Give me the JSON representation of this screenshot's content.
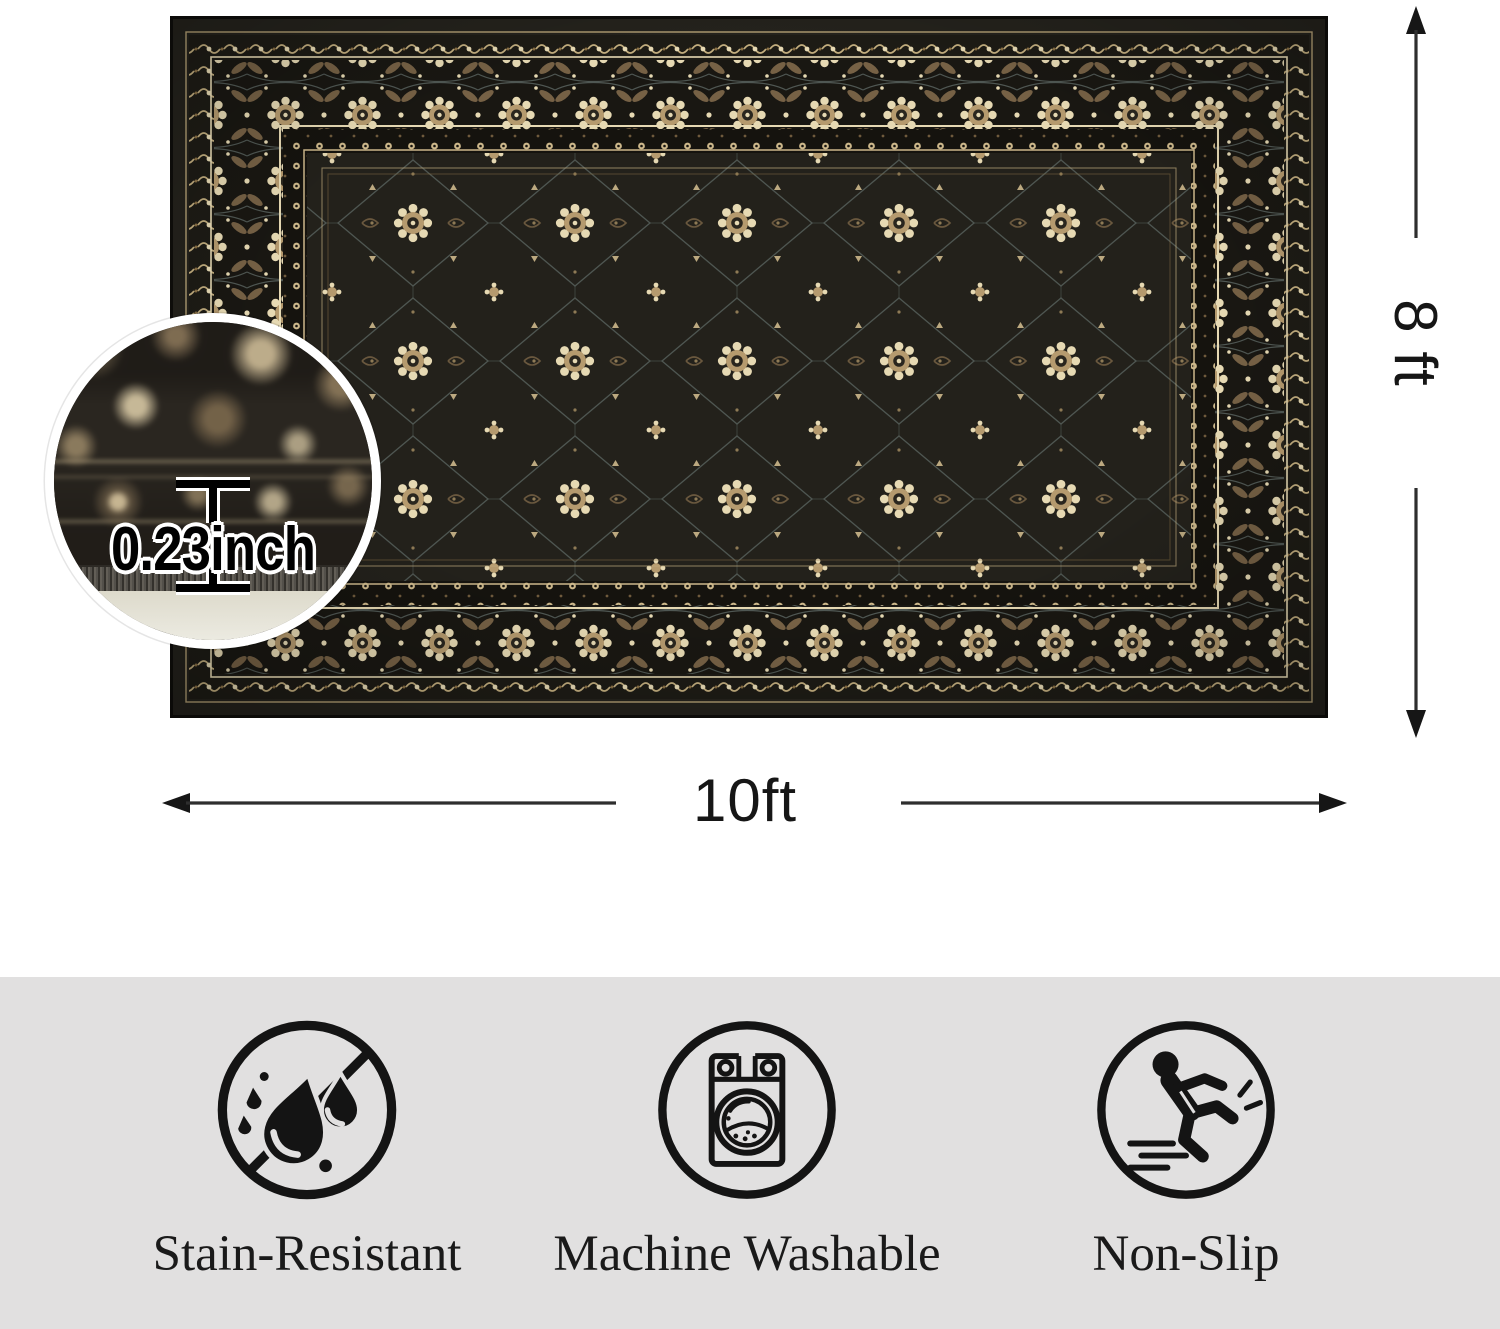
{
  "dimensions": {
    "width": "10ft",
    "height": "8 ft",
    "thickness": "0.23inch"
  },
  "features": {
    "band_bg": "#e1e0e0",
    "items": [
      {
        "label": "Stain-Resistant",
        "icon": "stain-resistant-icon"
      },
      {
        "label": "Machine Washable",
        "icon": "machine-washable-icon"
      },
      {
        "label": "Non-Slip",
        "icon": "non-slip-icon"
      }
    ]
  },
  "rug": {
    "colors": {
      "field": "#23211b",
      "border_bg": "#191712",
      "cream": "#e6d9b3",
      "tan": "#cdb88b",
      "brown": "#7b6547",
      "line_gray": "#59635f",
      "pile_edge": "#53504a",
      "backing": "#eae8dc"
    }
  }
}
